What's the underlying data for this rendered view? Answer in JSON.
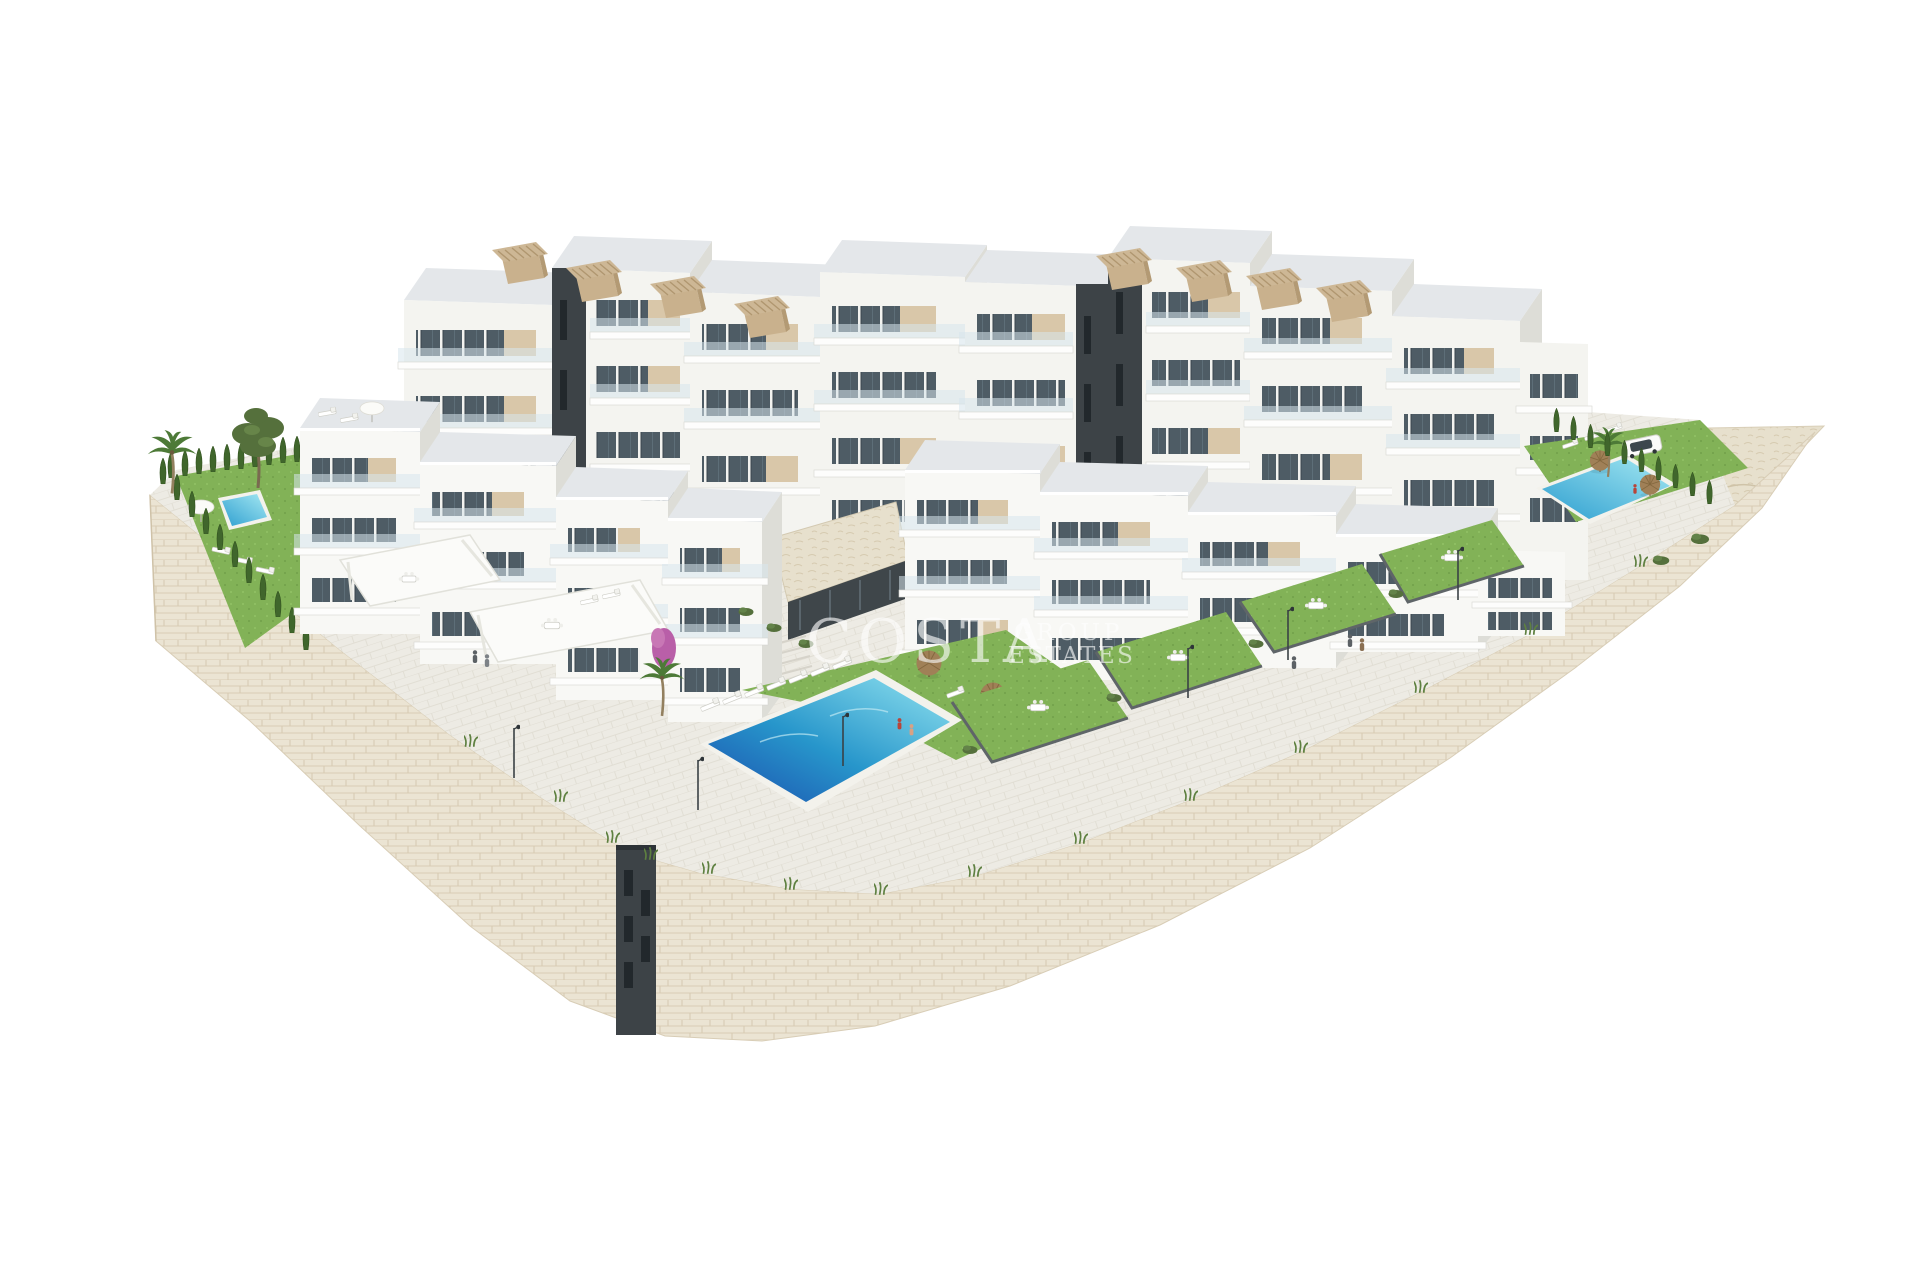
{
  "image": {
    "type": "architectural-3d-render",
    "description": "Aerial isometric 3D render of a modern hillside residential complex: white apartment blocks with beige accents and rooftop pergolas, terraced private gardens, three swimming pools, palm trees, cypress hedges, a parked car and a sweeping beige stone retaining wall, all on a plain white background",
    "background_color": "#ffffff"
  },
  "watermark": {
    "word_main": "COSTA",
    "word_top": "GROUP",
    "word_bottom": "ESTATES",
    "color": "#ffffff",
    "opacity": 0.62
  },
  "scene": {
    "pools": [
      "left-garden-pool",
      "central-main-pool",
      "right-terrace-pool"
    ],
    "pool_color_deep": "#1b4fae",
    "pool_color_shallow": "#90e2ef",
    "lawn_color": "#82b257",
    "hedge_color": "#40662c",
    "stone_wall_color": "#ebe4d3",
    "paving_color": "#edebe4",
    "facade_color": "#f8f8f5",
    "facade_accent_color": "#d9c7a9",
    "dark_core_color": "#3d4347",
    "pergola_color": "#cdb795",
    "car_color": "#fbfbfa",
    "elements": [
      "apartment-buildings",
      "rooftop-pergolas",
      "balconies-with-glass-railings",
      "sun-loungers",
      "straw-umbrellas",
      "white-parasols",
      "palm-trees",
      "pine-tree",
      "cypress-hedges",
      "private-lawn-gardens",
      "outdoor-dining-sets",
      "street-lamps",
      "stone-retaining-wall",
      "stone-slope",
      "stair-core",
      "parked-car",
      "people"
    ]
  }
}
